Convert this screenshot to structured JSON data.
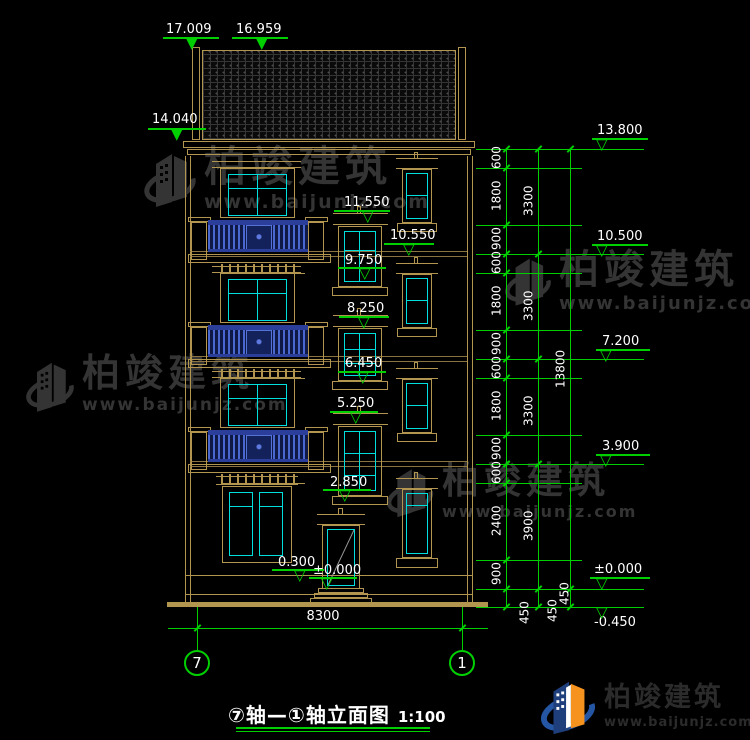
{
  "title": {
    "text": "⑦轴—①轴立面图",
    "scale": "1:100"
  },
  "axis": {
    "left": "7",
    "right": "1"
  },
  "dims": {
    "width_total": "8300"
  },
  "levels": {
    "top": [
      "17.009",
      "16.959",
      "14.040"
    ],
    "middle": [
      "11.550",
      "10.550",
      "9.750",
      "8.250",
      "6.450",
      "5.250",
      "2.850",
      "0.300",
      "±0.000"
    ],
    "right": [
      "13.800",
      "10.500",
      "7.200",
      "3.900",
      "±0.000",
      "-0.450"
    ]
  },
  "chains": {
    "a": [
      "600",
      "1800",
      "900",
      "600",
      "1800",
      "900",
      "600",
      "1800",
      "900",
      "600",
      "2400",
      "900",
      "450"
    ],
    "b": [
      "3300",
      "3300",
      "3300",
      "3900",
      "450"
    ],
    "c": [
      "13800",
      "450"
    ]
  },
  "watermark": {
    "name": "柏竣建筑",
    "url": "www.baijunjz.com"
  },
  "logo": {
    "name": "柏竣建筑",
    "url": "www.baijunjz.com"
  },
  "colors": {
    "line_tan": "#b2954e",
    "glass_cyan": "#00dede",
    "dim_green": "#00cf00",
    "rail_blue": "#4a67cf",
    "text_white": "#ffffff",
    "watermark_gray": "#343434",
    "logo_blue": "#1f3f7c",
    "logo_orange": "#f6921e"
  }
}
